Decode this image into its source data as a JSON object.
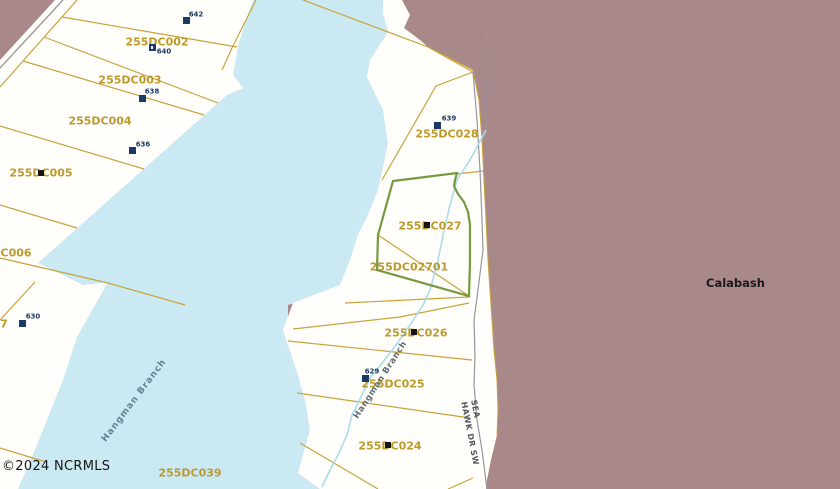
{
  "map": {
    "copyright": "©2024 NCRMLS",
    "place_label": "Calabash",
    "road": {
      "line1": "SEA",
      "line2": "HAWK DR SW"
    },
    "waterway_name": "Hangman Branch",
    "parcels": {
      "p002": {
        "id": "255DC002"
      },
      "p003": {
        "id": "255DC003"
      },
      "p004": {
        "id": "255DC004"
      },
      "p005": {
        "id": "255DC005"
      },
      "p006": {
        "id": "255DC006"
      },
      "p028": {
        "id": "255DC028"
      },
      "p027": {
        "id": "255DC027"
      },
      "p02701": {
        "id": "255DC02701"
      },
      "p026": {
        "id": "255DC026"
      },
      "p025": {
        "id": "255DC025"
      },
      "p024": {
        "id": "255DC024"
      },
      "p039": {
        "id": "255DC039"
      },
      "p_partial_left_edge": {
        "id": "7"
      }
    },
    "address_markers": {
      "m642": {
        "number": "642"
      },
      "m640": {
        "number": "640"
      },
      "m638": {
        "number": "638"
      },
      "m636": {
        "number": "636"
      },
      "m630": {
        "number": "630"
      },
      "m639": {
        "number": "639"
      },
      "m629": {
        "number": "629"
      }
    },
    "colors": {
      "background_municipal": "#a98889",
      "water": "#cbe9f3",
      "land": "#fffefa",
      "parcel_line": "#c8a33c",
      "parcel_label": "#bd992a",
      "selected_parcel_outline": "#74993f",
      "marker_navy": "#1b3a66",
      "marker_black": "#161616",
      "stream": "#abdcec",
      "road_line_gray": "#96969e"
    }
  }
}
